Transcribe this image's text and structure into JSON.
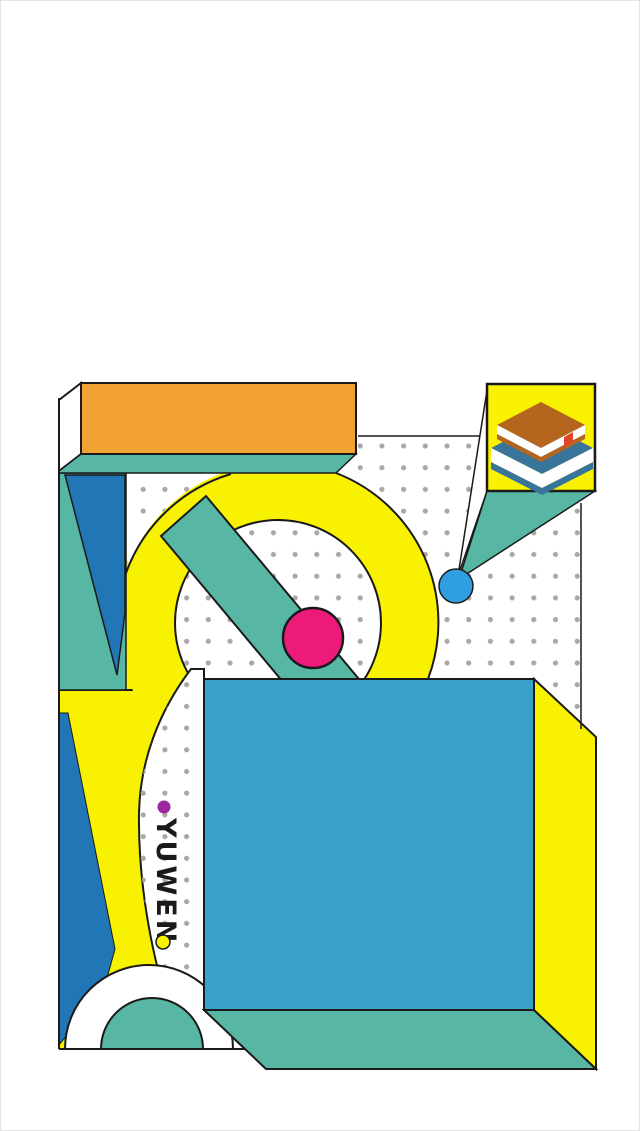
{
  "page": {
    "kind": "illustration-splash",
    "background": "#FFFFFF"
  },
  "brand": {
    "label": "YUWEN"
  },
  "icons": {
    "books": "stacked-books-isometric",
    "purple_bullet": "filled-circle",
    "yellow_bullet": "outlined-circle"
  },
  "palette": {
    "yellow": "#F8F100",
    "orange": "#F2A233",
    "teal": "#57B6A4",
    "darkBlue": "#2176B5",
    "boxBlue": "#3AA1C9",
    "skyBlue": "#2F9EE2",
    "pink": "#EE1A7B",
    "purple": "#9C27A0",
    "bookBrown": "#B5651E",
    "bookBlue": "#39759B",
    "bookmarkRed": "#E0452A",
    "dotGray": "#ACA7A3",
    "ink": "#1A1A1A",
    "white": "#FFFFFF"
  }
}
